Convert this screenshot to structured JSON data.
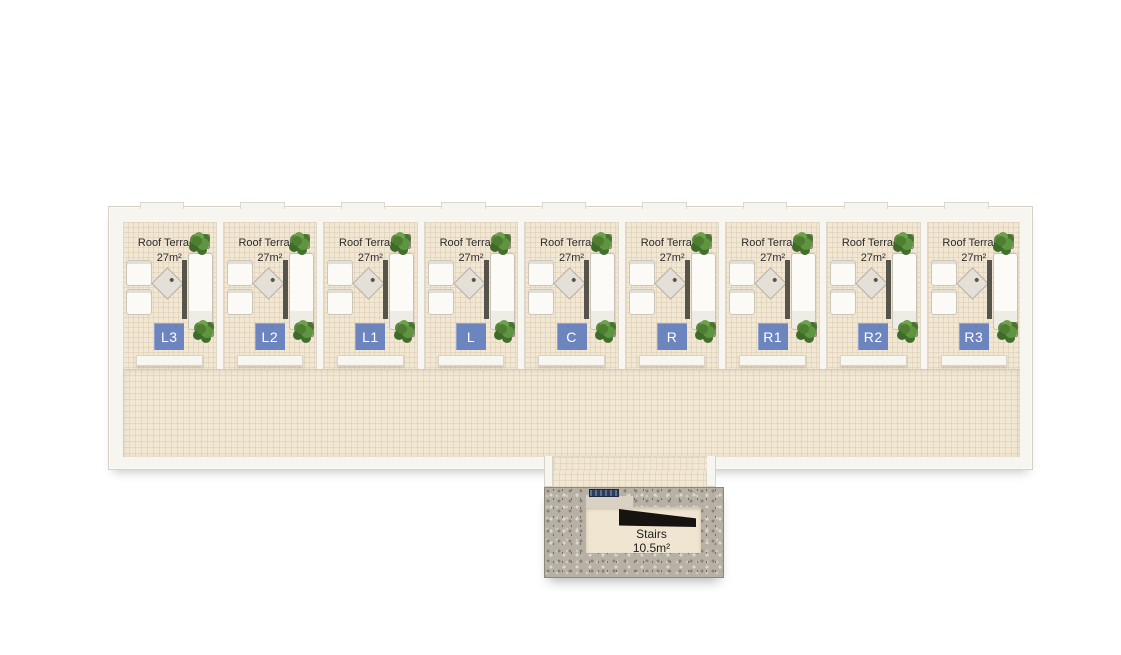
{
  "plan": {
    "units": [
      {
        "code": "L3",
        "label": "Roof Terrace",
        "area": "27m²"
      },
      {
        "code": "L2",
        "label": "Roof Terrace",
        "area": "27m²"
      },
      {
        "code": "L1",
        "label": "Roof Terrace",
        "area": "27m²"
      },
      {
        "code": "L",
        "label": "Roof Terrace",
        "area": "27m²"
      },
      {
        "code": "C",
        "label": "Roof Terrace",
        "area": "27m²"
      },
      {
        "code": "R",
        "label": "Roof Terrace",
        "area": "27m²"
      },
      {
        "code": "R1",
        "label": "Roof Terrace",
        "area": "27m²"
      },
      {
        "code": "R2",
        "label": "Roof Terrace",
        "area": "27m²"
      },
      {
        "code": "R3",
        "label": "Roof Terrace",
        "area": "27m²"
      }
    ],
    "stairs": {
      "label": "Stairs",
      "area": "10.5m²"
    },
    "colors": {
      "badge_blue": "#6d85be",
      "floor_beige": "#f1e7d3",
      "wall_white": "#f7f5f0",
      "stone_gray": "#b7b0a5",
      "plant_green": "#4f7e33",
      "text_dark": "#2c2c2c",
      "background": "#ffffff"
    }
  }
}
